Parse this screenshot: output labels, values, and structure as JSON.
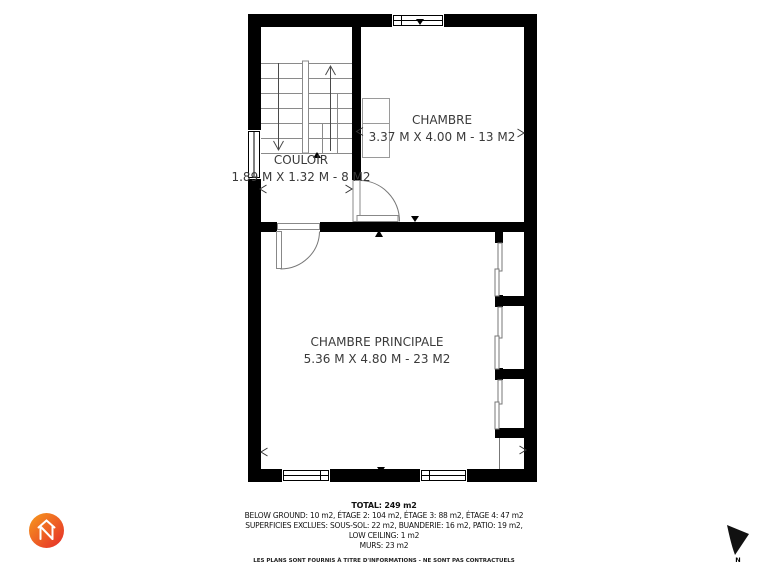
{
  "plan": {
    "rooms": [
      {
        "id": "chambre",
        "name": "CHAMBRE",
        "dimensions": "3.37 M X 4.00 M - 13 M2"
      },
      {
        "id": "couloir",
        "name": "COULOIR",
        "dimensions": "1.89 M X 1.32 M - 8 M2"
      },
      {
        "id": "chambre-principale",
        "name": "CHAMBRE PRINCIPALE",
        "dimensions": "5.36 M X 4.80 M - 23 M2"
      }
    ],
    "compass_label": "N"
  },
  "summary": {
    "total": "TOTAL: 249 m2",
    "areas_line": "BELOW GROUND: 10 m2, ÉTAGE 2: 104 m2, ÉTAGE 3: 88 m2, ÉTAGE 4: 47 m2",
    "excluded_line": "SUPERFICIES EXCLUES: SOUS-SOL: 22 m2, BUANDERIE: 16 m2, PATIO: 19 m2,",
    "low_ceiling_line": "LOW CEILING: 1 m2",
    "walls_line": "MURS: 23 m2",
    "disclaimer": "LES PLANS SONT FOURNIS À TITRE D'INFORMATIONS - NE SONT PAS CONTRACTUELS"
  },
  "colors": {
    "wall": "#000000",
    "thin_line": "#888888",
    "text": "#3a3a3a",
    "logo_gradient_start": "#f79b1d",
    "logo_gradient_end": "#e52a2a"
  }
}
